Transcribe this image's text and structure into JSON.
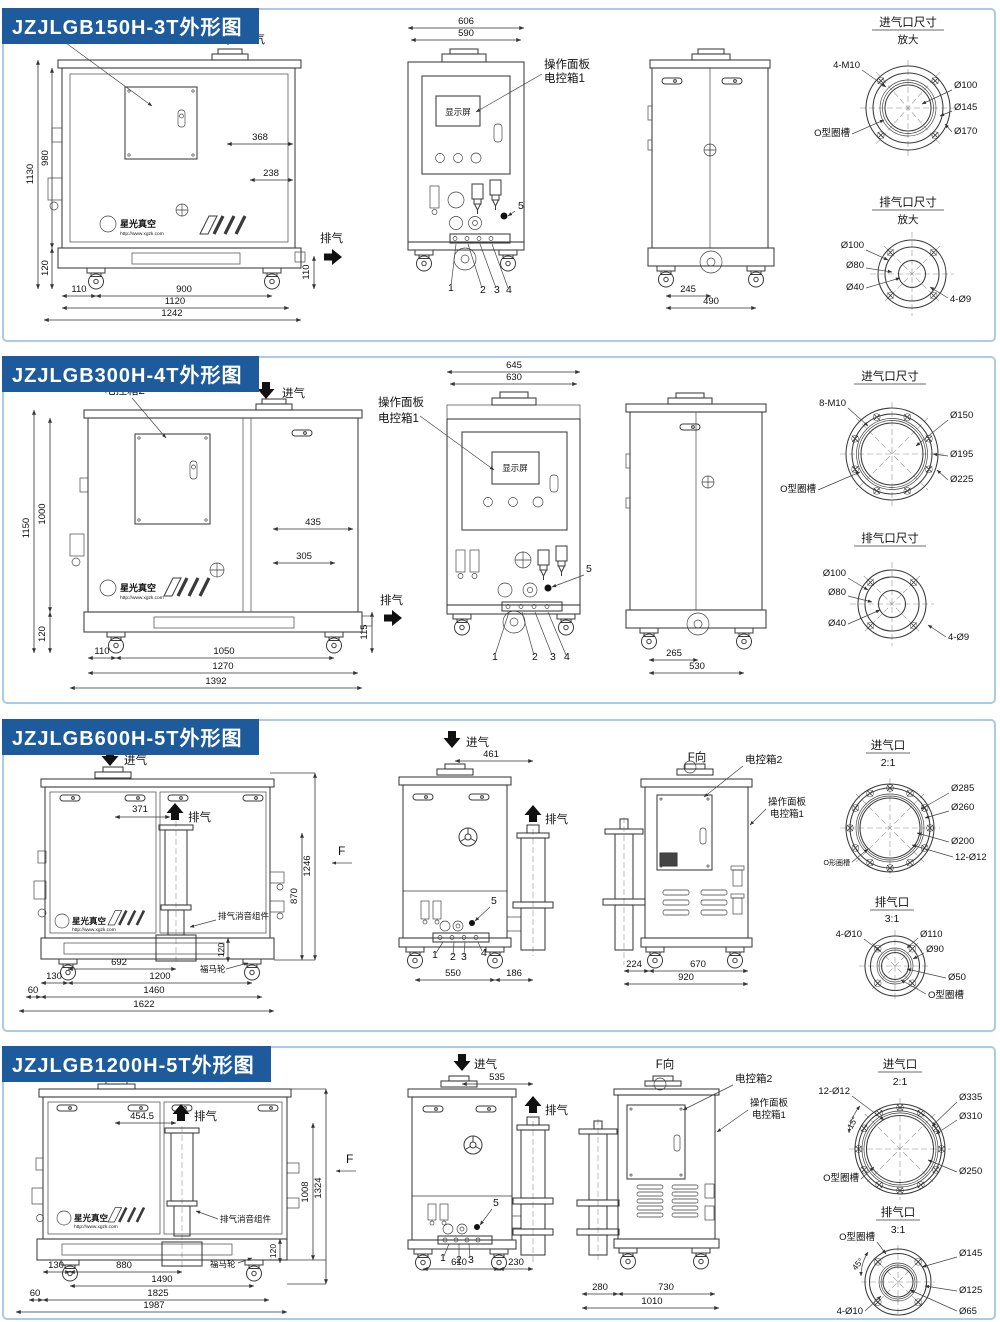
{
  "logo": {
    "brand": "星光真空",
    "url": "http://www.xgzk.com"
  },
  "shared": {
    "intake": "进气",
    "exhaust": "排气",
    "screen": "显示屏",
    "op_panel": "操作面板",
    "ebox1": "电控箱1",
    "ebox2": "电控箱2",
    "muffler": "排气消音组件",
    "caster": "福马轮",
    "fview": "F向",
    "f": "F",
    "n1": "1",
    "n2": "2",
    "n3": "3",
    "n4": "4",
    "n5": "5"
  },
  "panels": [
    {
      "title": "JZJLGB150H-3T外形图",
      "left": {
        "h_total": "1130",
        "h_body": "980",
        "w_368": "368",
        "w_238": "238",
        "h_base": "120",
        "h_exh": "110",
        "b_110": "110",
        "b_900": "900",
        "b_1120": "1120",
        "b_1242": "1242"
      },
      "front": {
        "w_outer": "606",
        "w_inner": "590"
      },
      "rear": {
        "b_245": "245",
        "b_490": "490"
      },
      "intake_port": {
        "title": "进气口尺寸",
        "scale": "放大",
        "bolts": "4-M10",
        "oring": "O型圈槽",
        "d1": "Ø100",
        "d2": "Ø145",
        "d3": "Ø170"
      },
      "exhaust_port": {
        "title": "排气口尺寸",
        "scale": "放大",
        "d1": "Ø100",
        "d2": "Ø80",
        "d3": "Ø40",
        "bolts": "4-Ø9"
      }
    },
    {
      "title": "JZJLGB300H-4T外形图",
      "left": {
        "h_total": "1150",
        "h_body": "1000",
        "w_435": "435",
        "w_305": "305",
        "h_base": "120",
        "h_exh": "115",
        "b_110": "110",
        "b_1050": "1050",
        "b_1270": "1270",
        "b_1392": "1392"
      },
      "front": {
        "w_outer": "645",
        "w_inner": "630"
      },
      "rear": {
        "b_265": "265",
        "b_530": "530"
      },
      "intake_port": {
        "title": "进气口尺寸",
        "bolts": "8-M10",
        "oring": "O型圈槽",
        "d1": "Ø150",
        "d2": "Ø195",
        "d3": "Ø225"
      },
      "exhaust_port": {
        "title": "排气口尺寸",
        "d1": "Ø100",
        "d2": "Ø80",
        "d3": "Ø40",
        "bolts": "4-Ø9"
      }
    },
    {
      "title": "JZJLGB600H-5T外形图",
      "left": {
        "w_371": "371",
        "h_870": "870",
        "h_total": "1246",
        "h_base": "120",
        "b_130": "130",
        "b_692": "692",
        "b_1200": "1200",
        "b_60": "60",
        "b_1460": "1460",
        "b_1622": "1622"
      },
      "front": {
        "w_461": "461",
        "b_550": "550",
        "b_186": "186"
      },
      "fv": {
        "b_224": "224",
        "b_670": "670",
        "b_920": "920"
      },
      "intake_port": {
        "title": "进气口",
        "scale": "2:1",
        "bolts": "12-Ø12",
        "oring": "O形圈槽",
        "d1": "Ø285",
        "d2": "Ø260",
        "d3": "Ø200"
      },
      "exhaust_port": {
        "title": "排气口",
        "scale": "3:1",
        "bolts": "4-Ø10",
        "oring": "O型圈槽",
        "d1": "Ø110",
        "d2": "Ø90",
        "d3": "Ø50"
      }
    },
    {
      "title": "JZJLGB1200H-5T外形图",
      "left": {
        "w_4545": "454.5",
        "h_1008": "1008",
        "h_total": "1324",
        "h_base": "120",
        "b_130": "130",
        "b_880": "880",
        "b_1490": "1490",
        "b_60": "60",
        "b_1825": "1825",
        "b_1987": "1987"
      },
      "front": {
        "w_535": "535",
        "b_610": "610",
        "b_230": "230"
      },
      "fv": {
        "b_280": "280",
        "b_730": "730",
        "b_1010": "1010"
      },
      "intake_port": {
        "title": "进气口",
        "scale": "2:1",
        "bolts": "12-Ø12",
        "angle": "15°",
        "oring": "O型圈槽",
        "d1": "Ø335",
        "d2": "Ø310",
        "d3": "Ø250"
      },
      "exhaust_port": {
        "title": "排气口",
        "scale": "3:1",
        "bolts": "4-Ø10",
        "angle": "45°",
        "oring": "O型圈槽",
        "d1": "Ø145",
        "d2": "Ø125",
        "d3": "Ø65"
      }
    }
  ]
}
